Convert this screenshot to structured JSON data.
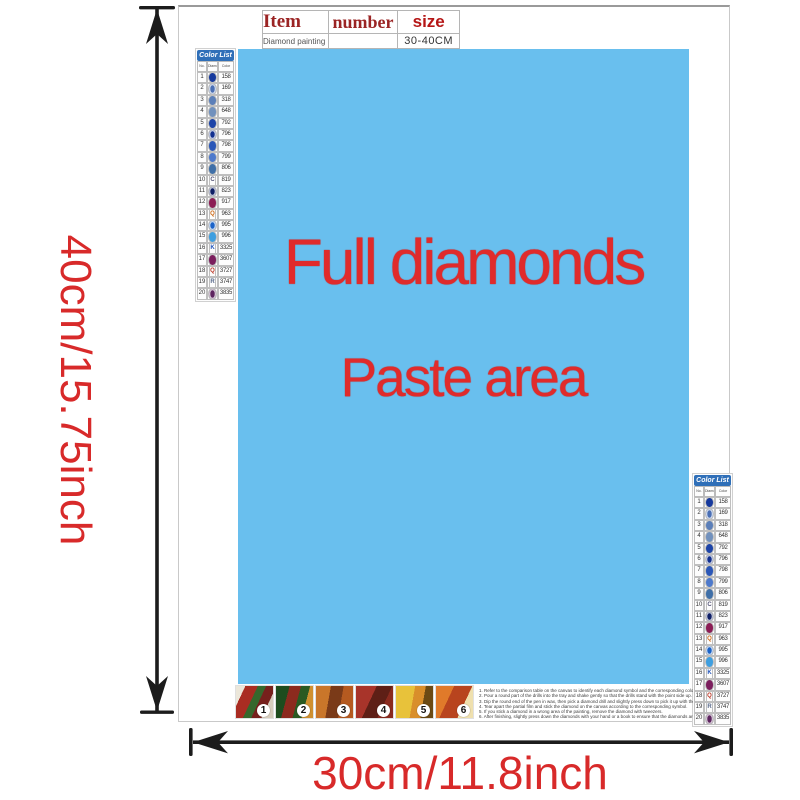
{
  "dimensions": {
    "height_label": "40cm/15.75inch",
    "width_label": "30cm/11.8inch",
    "arrow_color": "#1c1c1c",
    "label_color": "#d82a2a"
  },
  "item_table": {
    "headers": [
      "Item",
      "number",
      "size"
    ],
    "row": {
      "item": "Diamond painting",
      "number": "",
      "size": "30-40CM"
    }
  },
  "paste_area": {
    "line1": "Full diamonds",
    "line2": "Paste area",
    "background_color": "#69bfee",
    "text_color": "#e02b2b"
  },
  "color_list": {
    "title": "Color List",
    "header_bg": "#2f6fb8",
    "columns": [
      "No.",
      "Diamond",
      "Color"
    ],
    "rows": [
      {
        "no": "1",
        "letter": "",
        "dot": "#16399d",
        "ring": false,
        "code": "158"
      },
      {
        "no": "2",
        "letter": "",
        "dot": "#4a6fb5",
        "ring": true,
        "code": "169"
      },
      {
        "no": "3",
        "letter": "",
        "dot": "#5b7fb9",
        "ring": false,
        "code": "318"
      },
      {
        "no": "4",
        "letter": "",
        "dot": "#7191bd",
        "ring": false,
        "code": "648"
      },
      {
        "no": "5",
        "letter": "",
        "dot": "#1d44a8",
        "ring": false,
        "code": "792"
      },
      {
        "no": "6",
        "letter": "",
        "dot": "#12308f",
        "ring": true,
        "code": "796"
      },
      {
        "no": "7",
        "letter": "",
        "dot": "#2b57b8",
        "ring": false,
        "code": "798"
      },
      {
        "no": "8",
        "letter": "",
        "dot": "#4d79cc",
        "ring": false,
        "code": "799"
      },
      {
        "no": "9",
        "letter": "",
        "dot": "#3f6fa8",
        "ring": false,
        "code": "806"
      },
      {
        "no": "10",
        "letter": "C",
        "dot": "#555577",
        "ring": false,
        "code": "819"
      },
      {
        "no": "11",
        "letter": "",
        "dot": "#0f1f66",
        "ring": true,
        "code": "823"
      },
      {
        "no": "12",
        "letter": "",
        "dot": "#8c1d55",
        "ring": false,
        "code": "917"
      },
      {
        "no": "13",
        "letter": "Q",
        "dot": "#cc6611",
        "ring": false,
        "code": "963"
      },
      {
        "no": "14",
        "letter": "",
        "dot": "#1b63c8",
        "ring": true,
        "code": "995"
      },
      {
        "no": "15",
        "letter": "",
        "dot": "#3f9fe0",
        "ring": false,
        "code": "996"
      },
      {
        "no": "16",
        "letter": "K",
        "dot": "#2255bb",
        "ring": false,
        "code": "3325"
      },
      {
        "no": "17",
        "letter": "",
        "dot": "#7c1f5e",
        "ring": false,
        "code": "3607"
      },
      {
        "no": "18",
        "letter": "Q",
        "dot": "#bb3322",
        "ring": false,
        "code": "3727"
      },
      {
        "no": "19",
        "letter": "R",
        "dot": "#556688",
        "ring": false,
        "code": "3747"
      },
      {
        "no": "20",
        "letter": "",
        "dot": "#5e2560",
        "ring": true,
        "code": "3835"
      }
    ]
  },
  "footer": {
    "step_numbers": [
      "1",
      "2",
      "3",
      "4",
      "5",
      "6"
    ],
    "instruction_lines": [
      "1. Refer to the comparison table on the canvas to identify each diamond symbol and the corresponding color number on the canvas.",
      "2. Pour a round part of the drills into the tray and shake gently so that the drills stand with the point side up.",
      "3. Dip the round end of the pen in wax, then pick a diamond drill and slightly press down to pick it up with the pen.",
      "4. Tear apart the partial film and stick the diamond on the canvas according to the corresponding symbol.",
      "5. If you stick a diamond in a wrong area of the painting, remove the diamond with tweezers.",
      "6. After finishing, slightly press down the diamonds with your hand or a book to ensure that the diamonds are firmly attached."
    ]
  }
}
